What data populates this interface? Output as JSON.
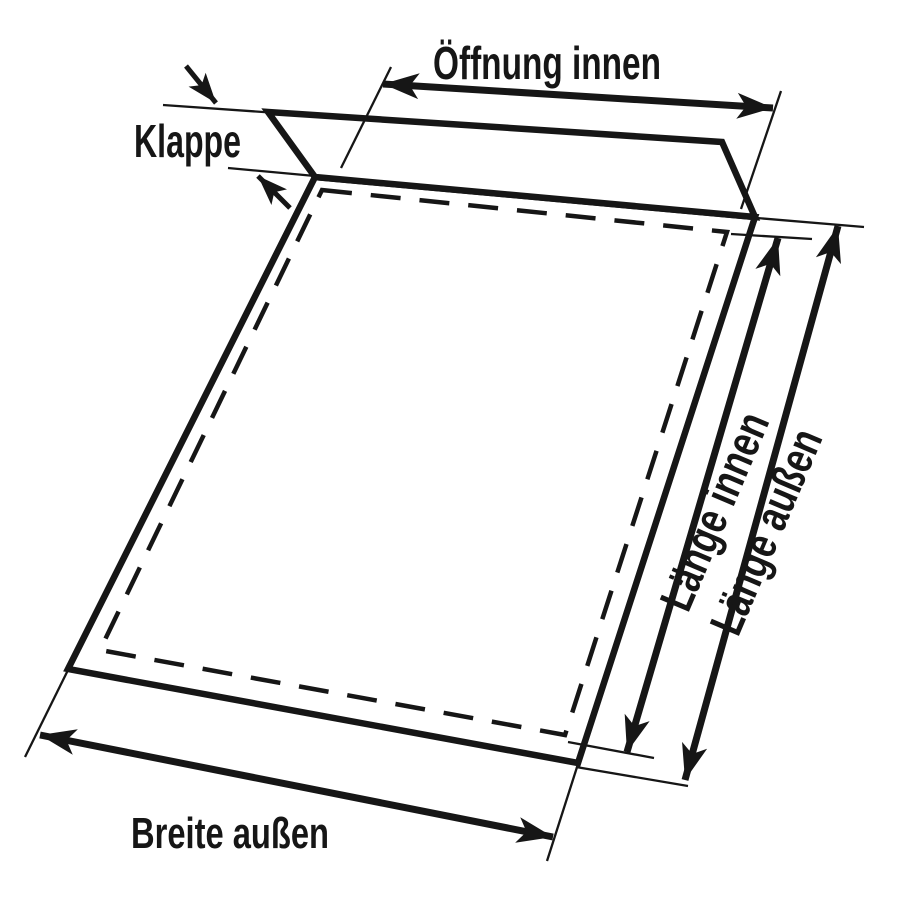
{
  "labels": {
    "opening_inner": "Öffnung innen",
    "flap": "Klappe",
    "length_inner": "Länge innen",
    "length_outer": "Länge außen",
    "width_outer": "Breite außen"
  },
  "colors": {
    "background": "#ffffff",
    "ink": "#161616"
  }
}
